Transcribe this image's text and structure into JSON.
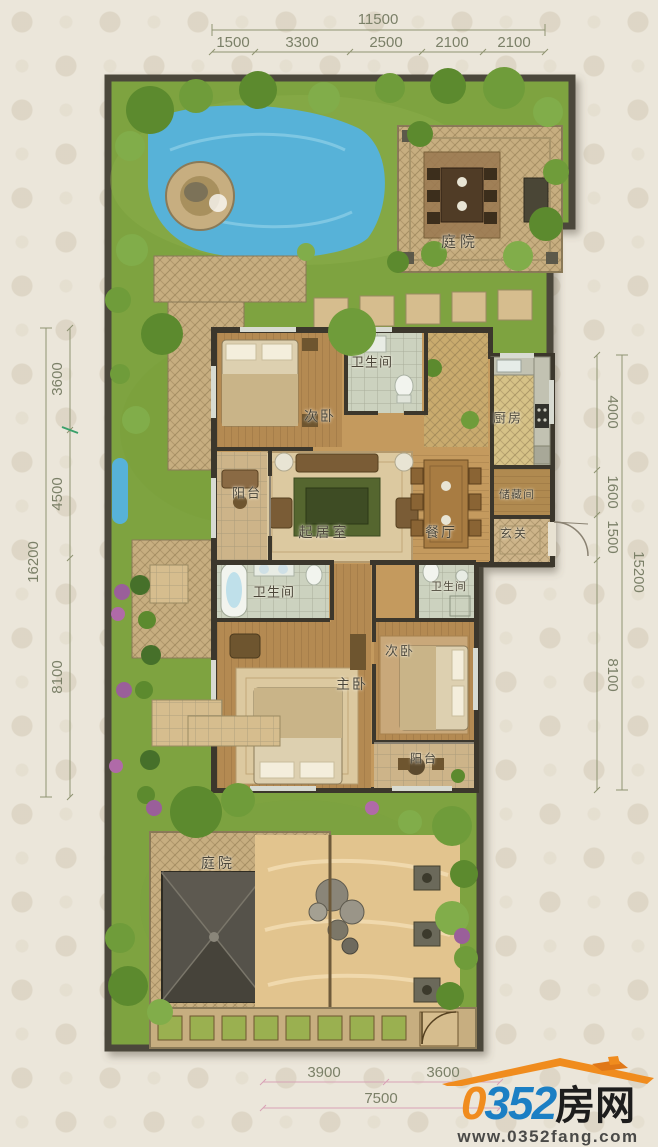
{
  "plan": {
    "rooms": [
      {
        "label": "庭院"
      },
      {
        "label": "次卧"
      },
      {
        "label": "卫生间"
      },
      {
        "label": "厨房"
      },
      {
        "label": "阳台"
      },
      {
        "label": "起居室"
      },
      {
        "label": "餐厅"
      },
      {
        "label": "储藏间"
      },
      {
        "label": "玄关"
      },
      {
        "label": "卫生间"
      },
      {
        "label": "卫生间"
      },
      {
        "label": "次卧"
      },
      {
        "label": "主卧"
      },
      {
        "label": "阳台"
      },
      {
        "label": "庭院"
      }
    ],
    "dimensions": {
      "top": {
        "total": "11500",
        "segments": [
          "1500",
          "3300",
          "2500",
          "2100",
          "2100"
        ]
      },
      "left": {
        "total": "16200",
        "segments": [
          "3600",
          "4500",
          "8100"
        ]
      },
      "right": {
        "total": "15200",
        "segments": [
          "4000",
          "1600",
          "1500",
          "8100"
        ]
      },
      "bottom": {
        "total": "7500",
        "segments": [
          "3900",
          "3600"
        ]
      }
    }
  },
  "watermark": {
    "number": "0352",
    "suffix": "房网",
    "url": "www.0352fang.com"
  },
  "colors": {
    "grass": "#7ea340",
    "paving": "#c7ae80",
    "wood_floor": "#c49a5e",
    "water": "#57b2d8",
    "sand": "#e2c48e",
    "wall": "#3c372c",
    "dim_text": "#7b8068",
    "dim_line": "#8f9472",
    "dim_line_bottom": "#d8a2b6",
    "logo_blue": "#1b7fc4",
    "logo_orange": "#f08c1e"
  }
}
